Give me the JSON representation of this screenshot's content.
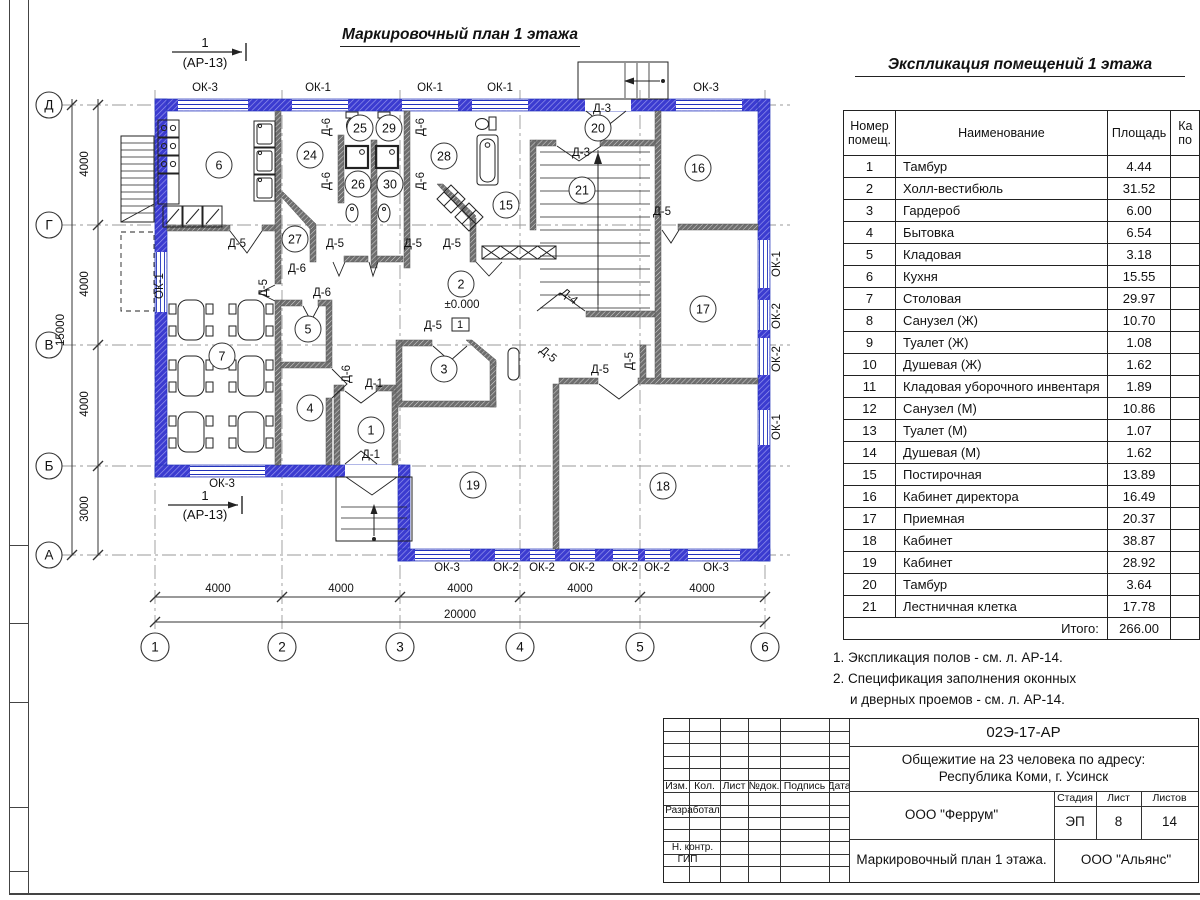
{
  "sheet": {
    "plan_title": "Маркировочный план 1 этажа",
    "notes": [
      "1. Экспликация полов - см. л. АР-14.",
      "2. Спецификация заполнения оконных",
      "и дверных проемов - см. л. АР-14."
    ]
  },
  "table": {
    "title": "Экспликация помещений 1 этажа",
    "h_num": "Номер помещ.",
    "h_name": "Наименование",
    "h_area": "Площадь",
    "h_cut1": "Ка",
    "h_cut2": "по",
    "rows": [
      [
        "1",
        "Тамбур",
        "4.44"
      ],
      [
        "2",
        "Холл-вестибюль",
        "31.52"
      ],
      [
        "3",
        "Гардероб",
        "6.00"
      ],
      [
        "4",
        "Бытовка",
        "6.54"
      ],
      [
        "5",
        "Кладовая",
        "3.18"
      ],
      [
        "6",
        "Кухня",
        "15.55"
      ],
      [
        "7",
        "Столовая",
        "29.97"
      ],
      [
        "8",
        "Санузел (Ж)",
        "10.70"
      ],
      [
        "9",
        "Туалет (Ж)",
        "1.08"
      ],
      [
        "10",
        "Душевая (Ж)",
        "1.62"
      ],
      [
        "11",
        "Кладовая уборочного инвентаря",
        "1.89"
      ],
      [
        "12",
        "Санузел (М)",
        "10.86"
      ],
      [
        "13",
        "Туалет (М)",
        "1.07"
      ],
      [
        "14",
        "Душевая (М)",
        "1.62"
      ],
      [
        "15",
        "Постирочная",
        "13.89"
      ],
      [
        "16",
        "Кабинет директора",
        "16.49"
      ],
      [
        "17",
        "Приемная",
        "20.37"
      ],
      [
        "18",
        "Кабинет",
        "38.87"
      ],
      [
        "19",
        "Кабинет",
        "28.92"
      ],
      [
        "20",
        "Тамбур",
        "3.64"
      ],
      [
        "21",
        "Лестничная клетка",
        "17.78"
      ]
    ],
    "total_label": "Итого:",
    "total": "266.00"
  },
  "plan": {
    "axis_rows": [
      [
        "Д",
        105
      ],
      [
        "Г",
        225
      ],
      [
        "В",
        345
      ],
      [
        "Б",
        466
      ],
      [
        "А",
        555
      ]
    ],
    "axis_cols": [
      [
        "1",
        155
      ],
      [
        "2",
        282
      ],
      [
        "3",
        400
      ],
      [
        "4",
        520
      ],
      [
        "5",
        640
      ],
      [
        "6",
        765
      ]
    ],
    "rooms": [
      {
        "n": "1",
        "x": 371,
        "y": 430
      },
      {
        "n": "2",
        "x": 461,
        "y": 284
      },
      {
        "n": "3",
        "x": 444,
        "y": 369
      },
      {
        "n": "4",
        "x": 310,
        "y": 408
      },
      {
        "n": "5",
        "x": 308,
        "y": 329
      },
      {
        "n": "6",
        "x": 219,
        "y": 165
      },
      {
        "n": "7",
        "x": 222,
        "y": 356
      },
      {
        "n": "15",
        "x": 506,
        "y": 205
      },
      {
        "n": "16",
        "x": 698,
        "y": 168
      },
      {
        "n": "17",
        "x": 703,
        "y": 309
      },
      {
        "n": "18",
        "x": 663,
        "y": 486
      },
      {
        "n": "19",
        "x": 473,
        "y": 485
      },
      {
        "n": "20",
        "x": 598,
        "y": 128
      },
      {
        "n": "21",
        "x": 582,
        "y": 190
      },
      {
        "n": "24",
        "x": 310,
        "y": 155
      },
      {
        "n": "25",
        "x": 360,
        "y": 128
      },
      {
        "n": "26",
        "x": 358,
        "y": 184
      },
      {
        "n": "27",
        "x": 295,
        "y": 239
      },
      {
        "n": "28",
        "x": 444,
        "y": 156
      },
      {
        "n": "29",
        "x": 389,
        "y": 128
      },
      {
        "n": "30",
        "x": 390,
        "y": 184
      }
    ],
    "texts": [
      [
        "ОК-3",
        205,
        91
      ],
      [
        "ОК-1",
        318,
        91
      ],
      [
        "ОК-1",
        430,
        91
      ],
      [
        "ОК-1",
        500,
        91
      ],
      [
        "ОК-3",
        706,
        91
      ],
      [
        "ОК-3",
        222,
        487
      ],
      [
        "ОК-3",
        447,
        571
      ],
      [
        "ОК-2",
        506,
        571
      ],
      [
        "ОК-2",
        542,
        571
      ],
      [
        "ОК-2",
        582,
        571
      ],
      [
        "ОК-2",
        625,
        571
      ],
      [
        "ОК-2",
        657,
        571
      ],
      [
        "ОК-3",
        716,
        571
      ],
      [
        "ОК-1",
        163,
        286,
        -90
      ],
      [
        "ОК-1",
        780,
        264,
        -90
      ],
      [
        "ОК-2",
        780,
        316,
        -90
      ],
      [
        "ОК-2",
        780,
        359,
        -90
      ],
      [
        "ОК-1",
        780,
        427,
        -90
      ],
      [
        "Д-6",
        330,
        127,
        -90
      ],
      [
        "Д-6",
        424,
        127,
        -90
      ],
      [
        "Д-6",
        330,
        181,
        -90
      ],
      [
        "Д-6",
        424,
        181,
        -90
      ],
      [
        "Д-6",
        350,
        374,
        -90
      ],
      [
        "Д-6",
        297,
        272
      ],
      [
        "Д-6",
        322,
        296
      ],
      [
        "Д-5",
        237,
        247
      ],
      [
        "Д-5",
        335,
        247
      ],
      [
        "Д-5",
        413,
        247
      ],
      [
        "Д-5",
        452,
        247
      ],
      [
        "Д-5",
        433,
        329
      ],
      [
        "Д-5",
        600,
        373
      ],
      [
        "Д-5",
        662,
        215
      ],
      [
        "Д-5",
        267,
        288,
        -90
      ],
      [
        "Д-5",
        633,
        361,
        -90
      ],
      [
        "Д-5",
        546,
        357,
        40
      ],
      [
        "Д-3",
        602,
        112
      ],
      [
        "Д-3",
        581,
        156
      ],
      [
        "Д-1",
        374,
        387
      ],
      [
        "Д-1",
        371,
        458
      ],
      [
        "Д-4",
        567,
        299,
        40
      ],
      [
        "4000",
        88,
        164,
        -90,
        "dim"
      ],
      [
        "4000",
        88,
        284,
        -90,
        "dim"
      ],
      [
        "4000",
        88,
        404,
        -90,
        "dim"
      ],
      [
        "3000",
        88,
        509,
        -90,
        "dim"
      ],
      [
        "15000",
        64,
        330,
        -90,
        "dim"
      ],
      [
        "4000",
        218,
        592,
        0,
        "dim"
      ],
      [
        "4000",
        341,
        592,
        0,
        "dim"
      ],
      [
        "4000",
        460,
        592,
        0,
        "dim"
      ],
      [
        "4000",
        580,
        592,
        0,
        "dim"
      ],
      [
        "4000",
        702,
        592,
        0,
        "dim"
      ],
      [
        "20000",
        460,
        618,
        0,
        "dim"
      ],
      [
        "1",
        205,
        47,
        0,
        "sec"
      ],
      [
        "(АР-13)",
        205,
        67,
        0,
        "sec"
      ],
      [
        "1",
        205,
        500,
        0,
        "sec"
      ],
      [
        "(АР-13)",
        205,
        519,
        0,
        "sec"
      ],
      [
        "±0.000",
        462,
        308,
        0,
        "lvl"
      ],
      [
        "1",
        460,
        328,
        0,
        "fm"
      ]
    ]
  },
  "titleblock": {
    "doc_code": "02Э-17-АР",
    "object_line1": "Общежитие на 23 человека по адресу:",
    "object_line2": "Республика Коми, г. Усинск",
    "org": "ООО \"Феррум\"",
    "stage_label": "Стадия",
    "sheet_label": "Лист",
    "sheets_label": "Листов",
    "stage": "ЭП",
    "sheet_no": "8",
    "sheets_total": "14",
    "sheet_title": "Маркировочный план 1 этажа.",
    "org2": "ООО \"Альянс\"",
    "cols": [
      "Изм.",
      "Кол.",
      "Лист",
      "№док.",
      "Подпись",
      "Дата"
    ],
    "roles": [
      "Разработал",
      "Н. контр.",
      "ГИП"
    ]
  }
}
